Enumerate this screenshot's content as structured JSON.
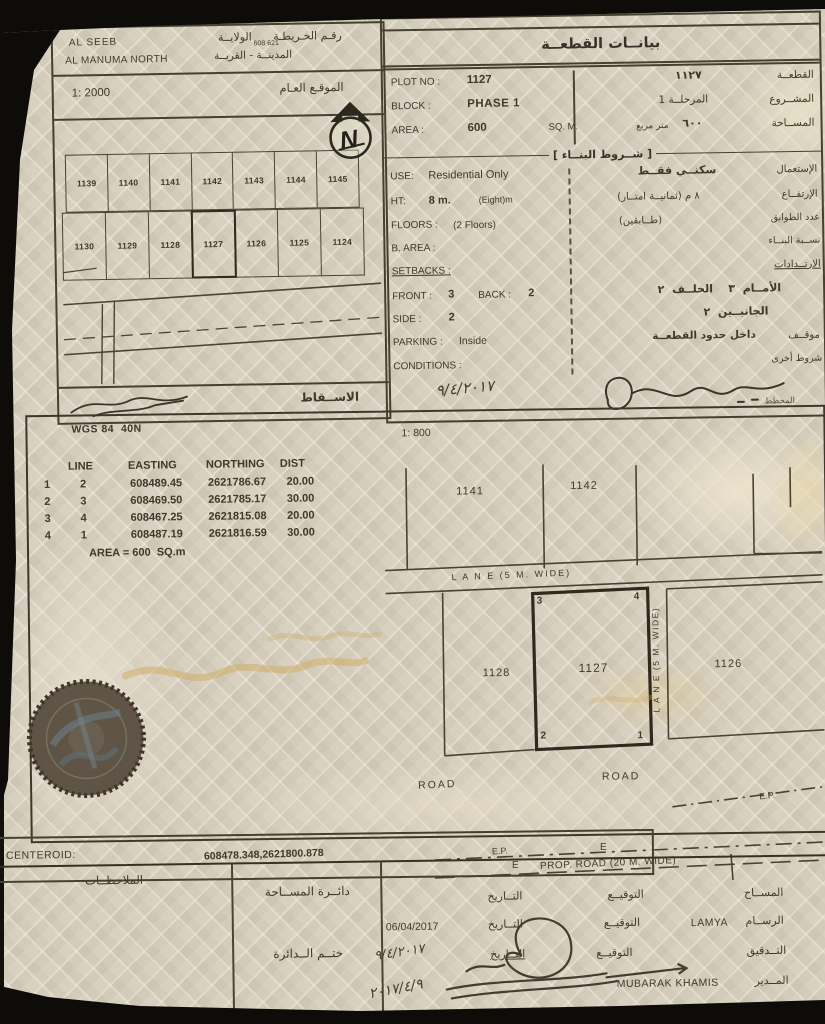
{
  "colors": {
    "paper": "#d8d1c1",
    "ink": "#3f392c",
    "line": "#46402f",
    "stamp": "#54493b",
    "gold": "#cfa95e"
  },
  "left_panel": {
    "region_line1": "AL SEEB",
    "region_line2": "AL MANUMA NORTH",
    "wilaya_label": "الولايــة",
    "map_no_label": "رقـم الخـريطـة",
    "map_no": "608 621",
    "city_village_label": "المدينــة - القريــة",
    "scale": "1: 2000",
    "general_site_label": "الموقـع العـام",
    "north_letter": "N",
    "plots_row1": [
      "1139",
      "1140",
      "1141",
      "1142",
      "1143",
      "1144",
      "1145"
    ],
    "plots_row2": [
      "1130",
      "1129",
      "1128",
      "1127",
      "1126",
      "1125",
      "1124"
    ],
    "projection_label": "الاســقاط"
  },
  "plot_info": {
    "title": "بيانــات القطعــة",
    "plot_no": {
      "label_en": "PLOT NO :",
      "value_en": "1127",
      "value_ar": "١١٢٧",
      "label_ar": "القطعــة"
    },
    "block": {
      "label_en": "BLOCK :",
      "value_en": "PHASE 1",
      "value_ar": "المرحلــة 1",
      "label_ar": "المشــروع"
    },
    "area": {
      "label_en": "AREA :",
      "value_en": "600",
      "unit_en": "SQ. M.",
      "unit_ar": "متر مربع",
      "value_ar": "٦٠٠",
      "label_ar": "المســاحة"
    }
  },
  "building": {
    "title": "[ شــروط البنــاء ]",
    "use": {
      "label_en": "USE:",
      "value_en": "Residential Only",
      "value_ar": "سكنــي فقــط",
      "label_ar": "الإستعمال"
    },
    "height": {
      "label_en": "HT:",
      "value_en": "8 m.",
      "note_en": "(Eight)m",
      "value_ar": "٨ م (ثمانيــة امتــار)",
      "label_ar": "الإرتفــاع"
    },
    "floors": {
      "label_en": "FLOORS :",
      "value_en": "(2 Floors)",
      "value_ar": "(طــابقين)",
      "label_ar": "عدد الطوابق"
    },
    "b_area": {
      "label_en": "B. AREA :",
      "label_ar": "نســبة البنــاء"
    },
    "setbacks": {
      "label_en": "SETBACKS :",
      "label_ar": "الإرتــدادات"
    },
    "front_back": {
      "label_en": "FRONT :",
      "value_en": "3",
      "label2_en": "BACK :",
      "value2_en": "2",
      "value_ar": "الأمــام  ٣    الخلــف  ٢"
    },
    "side": {
      "label_en": "SIDE :",
      "value_en": "2",
      "value_ar": "الجانبــين  ٢"
    },
    "parking": {
      "label_en": "PARKING :",
      "value_en": "Inside",
      "value_ar": "داخل حدود القطعــة",
      "label_ar": "موقــف"
    },
    "conditions": {
      "label_en": "CONDITIONS :",
      "label_ar": "شروط أخرى"
    },
    "handwritten_date": "٩/٤/٢٠١٧",
    "plan_label": "المخطط"
  },
  "survey": {
    "datum": "WGS 84  40N",
    "scale": "1: 800",
    "headers": [
      "LINE",
      "EASTING",
      "NORTHING",
      "DIST"
    ],
    "rows": [
      [
        "1",
        "2",
        "608489.45",
        "2621786.67",
        "20.00"
      ],
      [
        "2",
        "3",
        "608469.50",
        "2621785.17",
        "30.00"
      ],
      [
        "3",
        "4",
        "608467.25",
        "2621815.08",
        "20.00"
      ],
      [
        "4",
        "1",
        "608487.19",
        "2621816.59",
        "30.00"
      ]
    ],
    "area_note": "AREA = 600  SQ.m"
  },
  "site_plan": {
    "plot_top_left": "1141",
    "plot_top_right": "1142",
    "lane_h": "L A N E (5 M. WIDE)",
    "lane_v": "L A N E (5 M. WIDE)",
    "plot_left": "1128",
    "plot_center": "1127",
    "plot_right": "1126",
    "corner_tl": "3",
    "corner_tr": "4",
    "corner_bl": "2",
    "corner_br": "1",
    "road1": "ROAD",
    "road2": "ROAD",
    "ep1": "E.P.",
    "ep2": "E.P.",
    "e1": "E",
    "e2": "E",
    "prop_road": "PROP. ROAD (20 M. WIDE)"
  },
  "centeroid": {
    "label": "CENTEROID:",
    "value": "608478.348,2621800.878"
  },
  "footer": {
    "notes_label": "الملاحظــات",
    "survey_dept": "دائــرة المســاحة",
    "dept_stamp": "ختــم الــدائرة",
    "date_label": "التــاريخ",
    "sig_label": "التوقيــع",
    "surveyor_label": "المســاح",
    "draftsman_label": "الرســام",
    "checked_label": "التــدقيق",
    "director_label": "المــدير",
    "draftsman_name": "LAMYA",
    "draftsman_date": "06/04/2017",
    "director_name": "MUBARAK KHAMIS",
    "handwritten_date1": "٩/٤/٢٠١٧",
    "handwritten_date2": "٢٠١٧/٤/٩"
  }
}
